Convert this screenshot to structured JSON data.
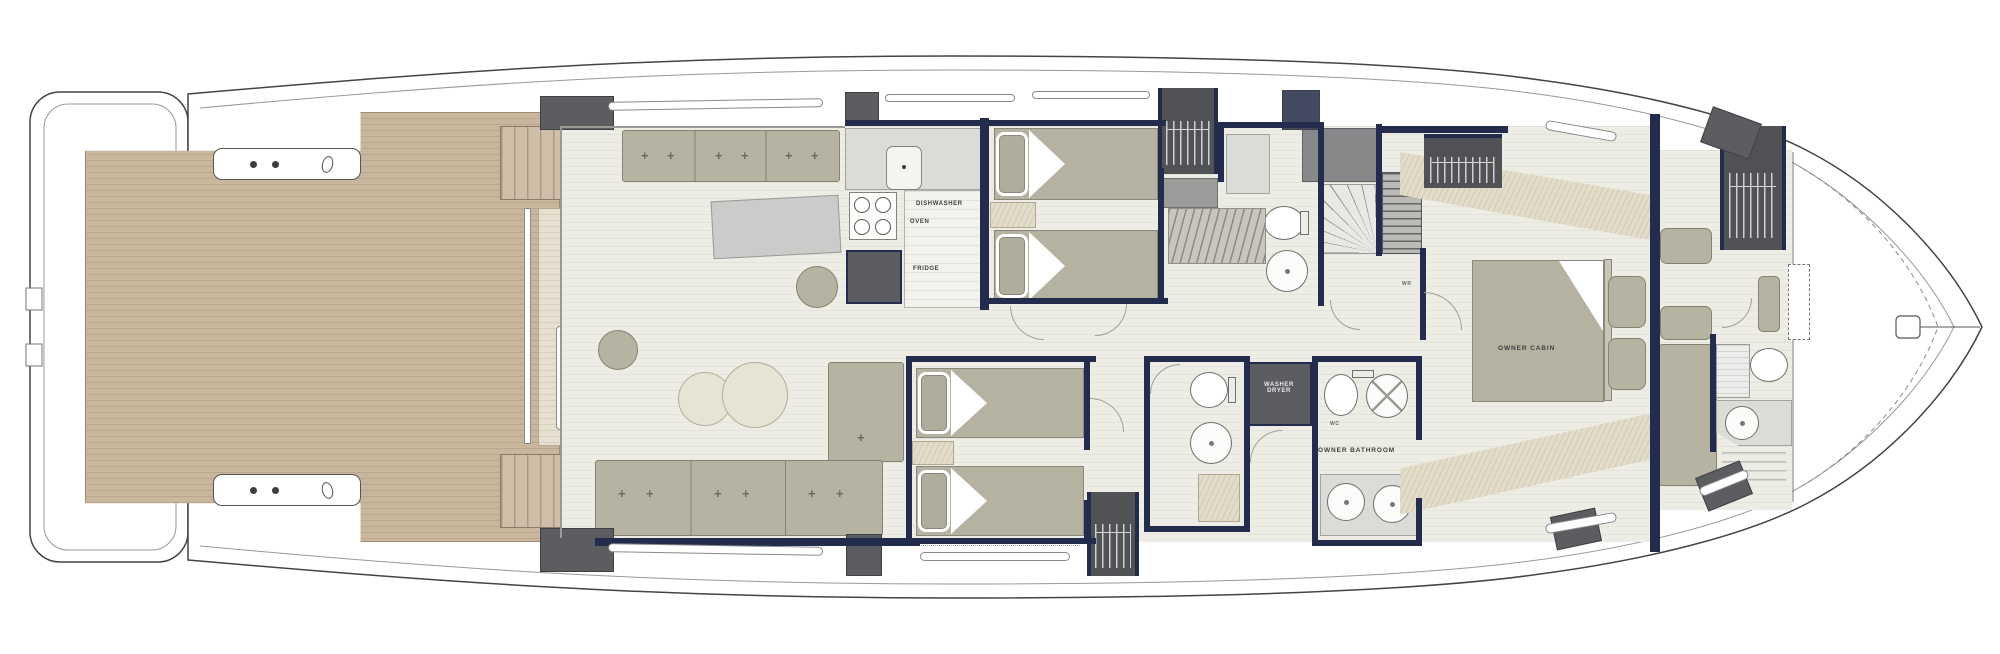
{
  "document": {
    "title": "Yacht deck floor plan"
  },
  "colors": {
    "wall_navy": "#232c4d",
    "teak": "#c8b79c",
    "furniture_sage": "#b6b3a2",
    "floor": "#edece5",
    "counter": "#dbdbd7",
    "dark_fixture": "#5c5d61"
  },
  "labels": {
    "dishwasher": "DISHWASHER",
    "oven": "OVEN",
    "fridge": "FRIDGE",
    "washer": "WASHER",
    "dryer": "DRYER",
    "owner_bathroom": "OWNER BATHROOM",
    "owner_cabin": "OWNER CABIN",
    "wc": "WC",
    "wardrobe": "WR"
  }
}
